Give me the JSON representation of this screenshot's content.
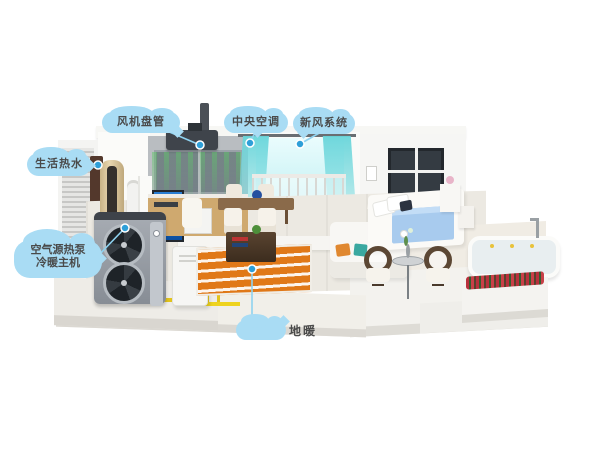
{
  "illustration": {
    "type": "heat-pump-home-cutaway-diagram",
    "callouts": {
      "fan_coil": "风机盘管",
      "central_ac": "中央空调",
      "fresh_air": "新风系统",
      "hot_water": "生活热水",
      "heat_pump_line1": "空气源热泵",
      "heat_pump_line2": "冷暖主机",
      "floor_heating": "地暖"
    },
    "colors": {
      "callout_cloud": "#a9dcf4",
      "pointer_line": "#8ed2f0",
      "pointer_dot": "#2e9fd8",
      "label_text": "#4a4a4a",
      "floor_heating_orange": "#e07818",
      "pipe_yellow": "#e2c41c",
      "airflow_green": "#5ec868",
      "curtain_teal": "#68d5da",
      "heat_pump_gray": "#9aa0a8",
      "bedding_blue": "#a8cbee"
    }
  }
}
